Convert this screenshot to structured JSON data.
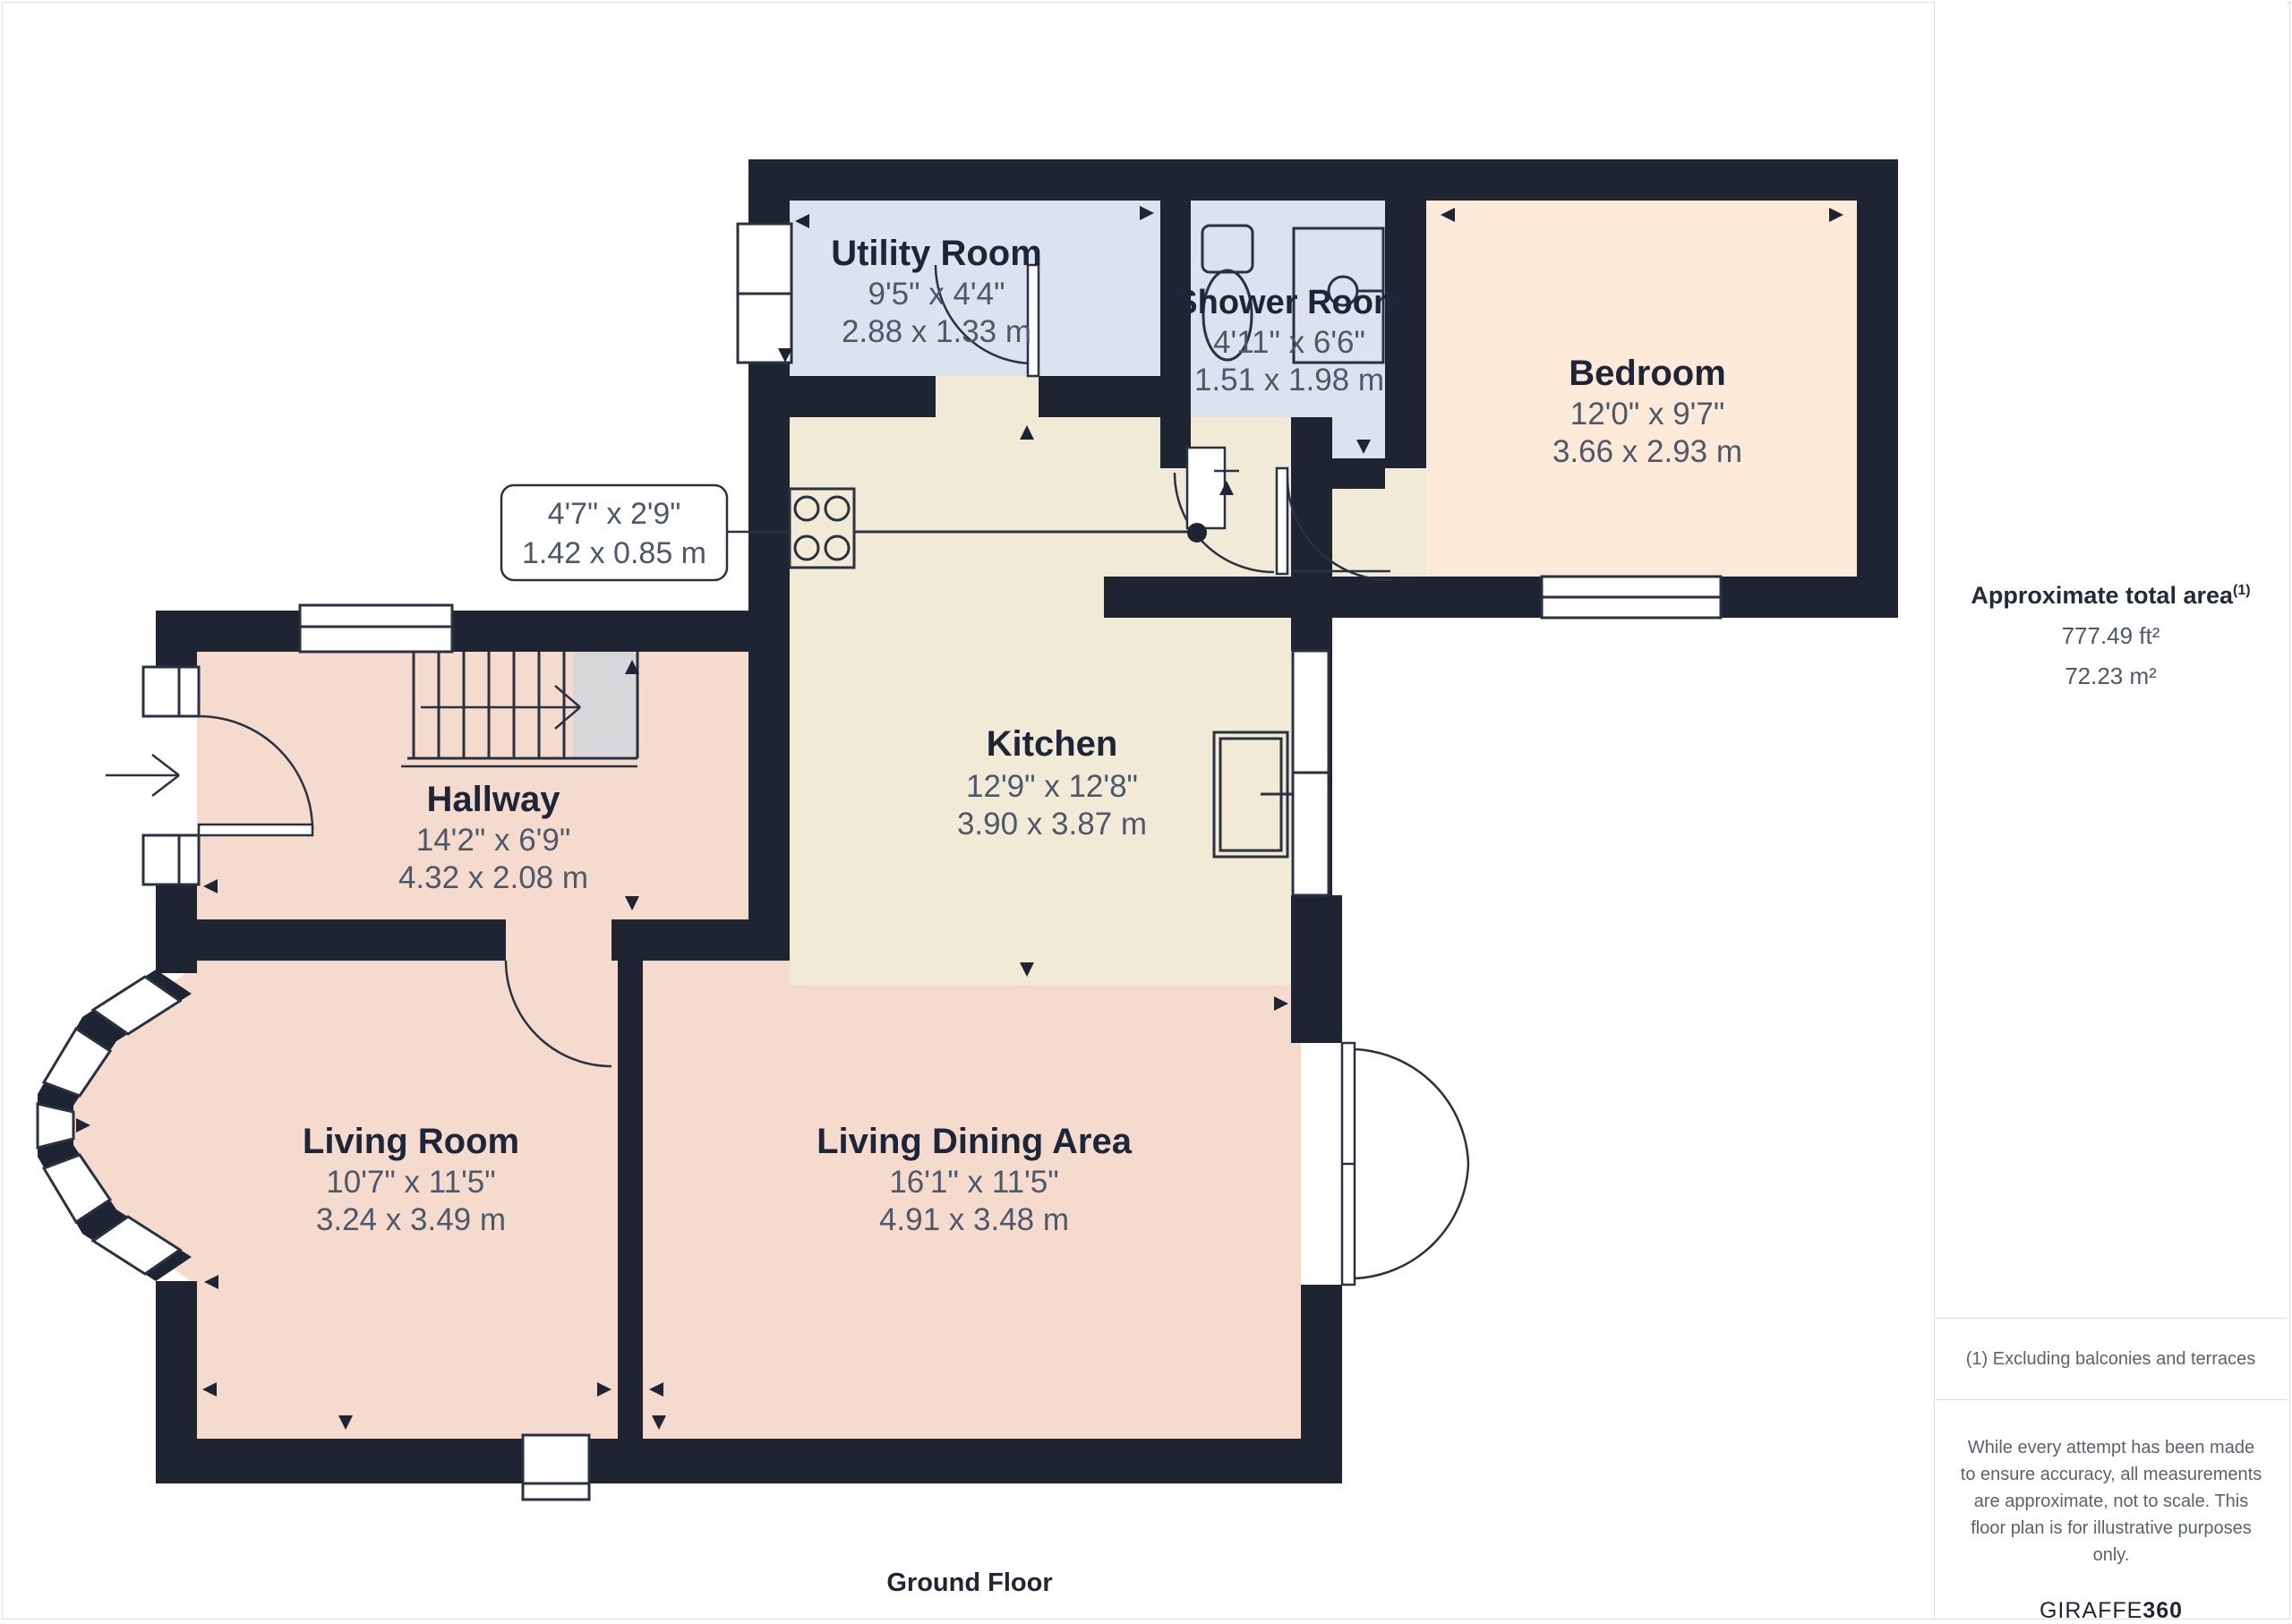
{
  "floor_title": "Ground Floor",
  "rooms": [
    {
      "name": "Utility Room",
      "imperial": "9'5\" x 4'4\"",
      "metric": "2.88 x 1.33 m"
    },
    {
      "name": "Shower Room",
      "imperial": "4'11\" x 6'6\"",
      "metric": "1.51 x 1.98 m"
    },
    {
      "name": "Bedroom",
      "imperial": "12'0\" x 9'7\"",
      "metric": "3.66 x 2.93 m"
    },
    {
      "name": "Kitchen",
      "imperial": "12'9\" x 12'8\"",
      "metric": "3.90 x 3.87 m"
    },
    {
      "name": "Hallway",
      "imperial": "14'2\" x 6'9\"",
      "metric": "4.32 x 2.08 m"
    },
    {
      "name": "Living Room",
      "imperial": "10'7\" x 11'5\"",
      "metric": "3.24 x 3.49 m"
    },
    {
      "name": "Living Dining Area",
      "imperial": "16'1\" x 11'5\"",
      "metric": "4.91 x 3.48 m"
    }
  ],
  "callout": {
    "imperial": "4'7\" x 2'9\"",
    "metric": "1.42 x 0.85 m"
  },
  "sidebar": {
    "area_title": "Approximate total area",
    "area_superscript": "(1)",
    "area_ft": "777.49 ft²",
    "area_m": "72.23 m²",
    "footnote": "(1) Excluding balconies and terraces",
    "disclaimer": "While every attempt has been made to ensure accuracy, all measurements are approximate, not to scale. This floor plan is for illustrative purposes only.",
    "brand_light": "GIRAFFE",
    "brand_bold": "360"
  },
  "colors": {
    "wall": "#1f2433",
    "line": "#2a3140",
    "lavender": "#dde2ef",
    "cream": "#f0ead6",
    "pink": "#f4dbce",
    "peach": "#fce9d7",
    "stair": "#d7d7d9",
    "label": "#1d2639",
    "dims": "#4e586b",
    "border": "#dedede"
  }
}
